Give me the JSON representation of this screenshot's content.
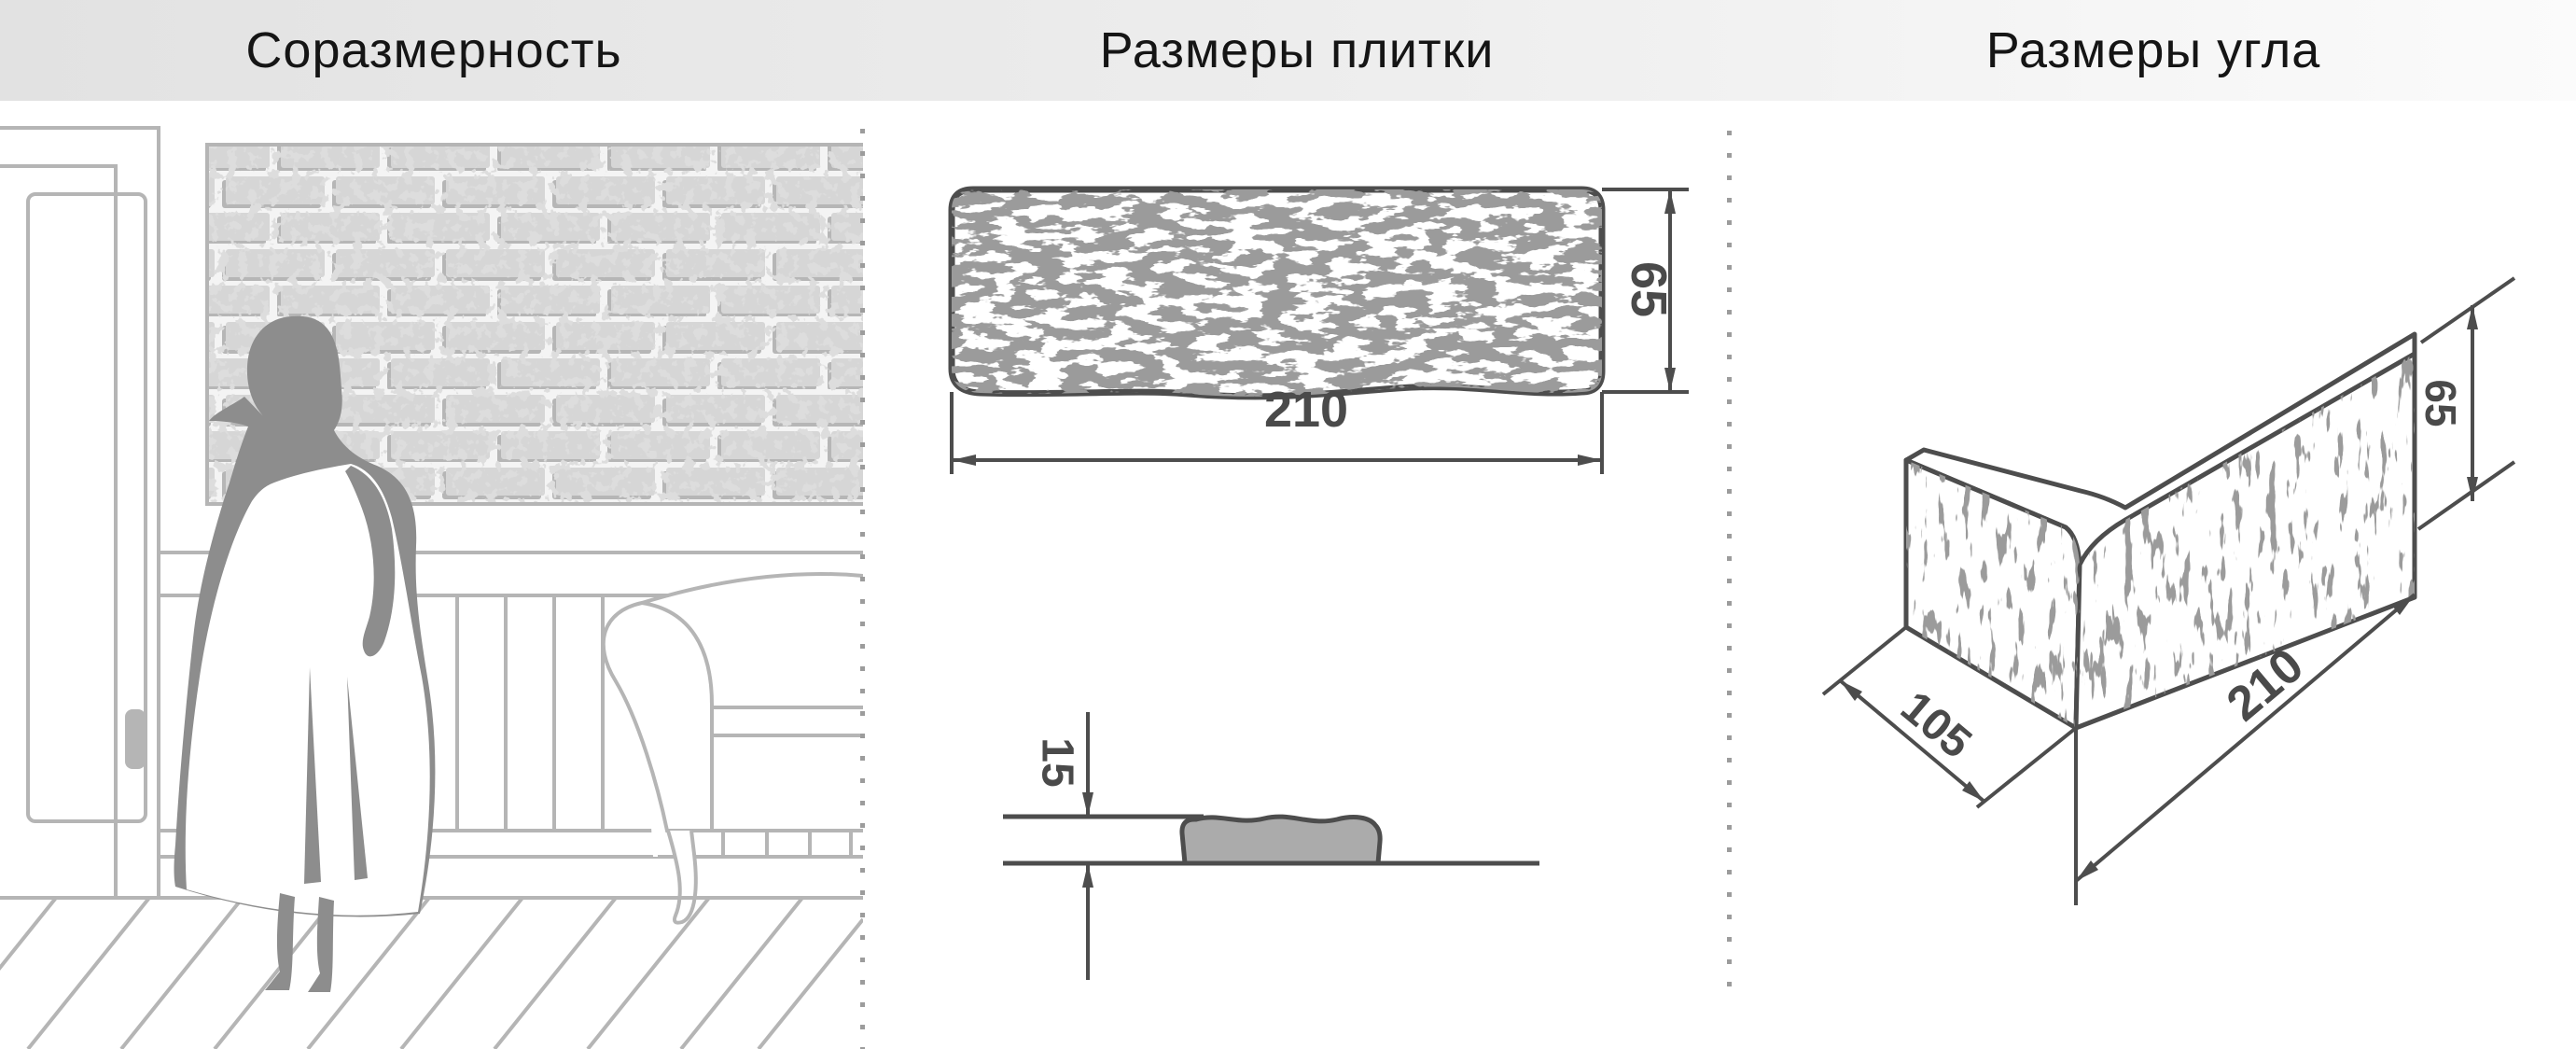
{
  "header": {
    "titles": [
      {
        "id": "proportion",
        "label": "Соразмерность"
      },
      {
        "id": "tile-dimensions",
        "label": "Размеры плитки"
      },
      {
        "id": "corner-dimensions",
        "label": "Размеры угла"
      }
    ]
  },
  "tile_front": {
    "width_mm": "210",
    "height_mm": "65"
  },
  "tile_profile": {
    "thickness_mm": "15"
  },
  "corner": {
    "depth_mm": "105",
    "length_mm": "210",
    "height_mm": "65"
  },
  "colors": {
    "header_bg_left": "#e2e2e2",
    "header_bg_right": "#fbfbfb",
    "title_text": "#151515",
    "dimension_line": "#4d4d4d",
    "dimension_text": "#4a4a4a",
    "tile_texture": "#545454",
    "profile_fill": "#ababab",
    "scene_line": "#b5b5b5",
    "silhouette": "#8d8d8d",
    "brick_face": "#d6d6d6",
    "brick_shadow": "#b6b6b6",
    "separator_dot": "#9c9c9c"
  }
}
